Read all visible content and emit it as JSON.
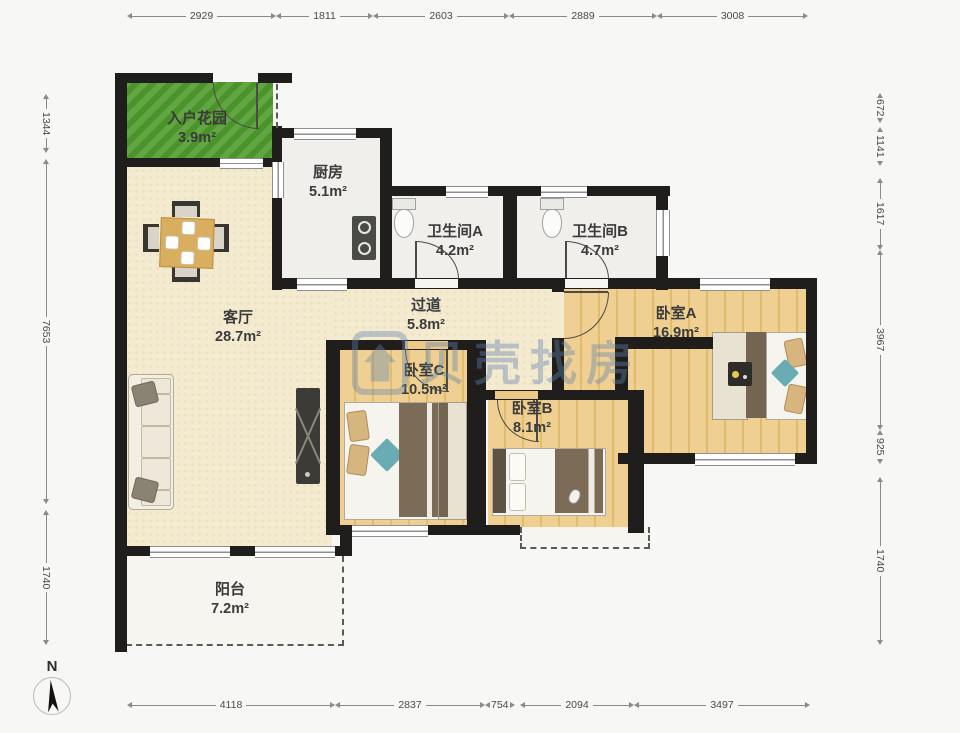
{
  "title": "apartment-floor-plan",
  "palette": {
    "wall": "#1f1e1c",
    "floor_cream": "#f3ead0",
    "floor_wood": "#ecc985",
    "garden_green": "#4f9c2d",
    "room_white": "#f0efeb",
    "watermark_blue": "#6082af",
    "teal_accent": "#6aacb4"
  },
  "rooms": {
    "garden": {
      "name": "入户花园",
      "area": "3.9m²"
    },
    "kitchen": {
      "name": "厨房",
      "area": "5.1m²"
    },
    "bathA": {
      "name": "卫生间A",
      "area": "4.2m²"
    },
    "bathB": {
      "name": "卫生间B",
      "area": "4.7m²"
    },
    "living": {
      "name": "客厅",
      "area": "28.7m²"
    },
    "hall": {
      "name": "过道",
      "area": "5.8m²"
    },
    "bedA": {
      "name": "卧室A",
      "area": "16.9m²"
    },
    "bedB": {
      "name": "卧室B",
      "area": "8.1m²"
    },
    "bedC": {
      "name": "卧室C",
      "area": "10.5m²"
    },
    "balcony": {
      "name": "阳台",
      "area": "7.2m²"
    }
  },
  "dims": {
    "top": [
      "2929",
      "1811",
      "2603",
      "2889",
      "3008"
    ],
    "bottom": [
      "4118",
      "2837",
      "754",
      "2094",
      "3497"
    ],
    "left": [
      "1344",
      "7653",
      "1740"
    ],
    "right": [
      "672",
      "1141",
      "1617",
      "3967",
      "925",
      "1740"
    ]
  },
  "watermark": {
    "text": "贝壳找房",
    "logo": "house-logo-icon"
  },
  "compass": {
    "label": "N"
  }
}
